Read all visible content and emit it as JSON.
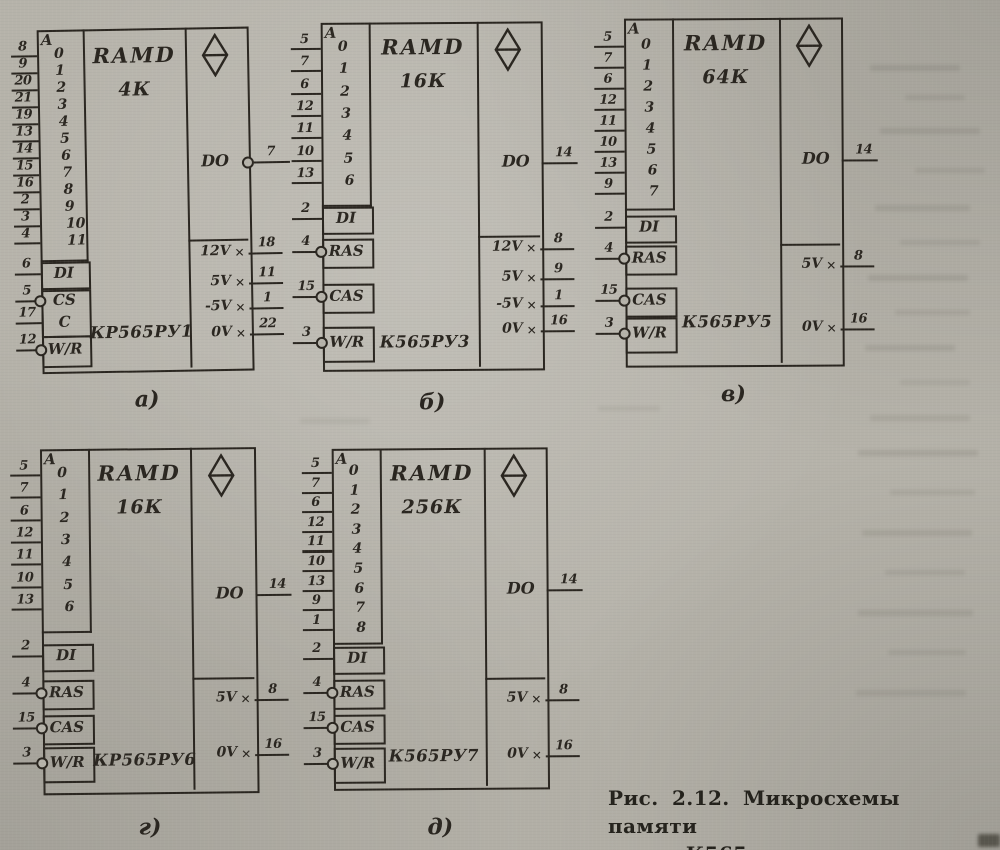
{
  "colors": {
    "paper": "#b6b3aa",
    "ink": "#2a2620"
  },
  "figure_caption": {
    "line1": "Рис. 2.12. Микросхемы памяти",
    "line2": "серии К565"
  },
  "chips": [
    {
      "id": "a",
      "sub_label": "а)",
      "block_label": "RAMD",
      "capacity_label": "4К",
      "part_number": "КР565РУ1",
      "address_header": "A",
      "address_pins": [
        {
          "bit": "0",
          "pin": "8"
        },
        {
          "bit": "1",
          "pin": "9"
        },
        {
          "bit": "2",
          "pin": "20"
        },
        {
          "bit": "3",
          "pin": "21"
        },
        {
          "bit": "4",
          "pin": "19"
        },
        {
          "bit": "5",
          "pin": "13"
        },
        {
          "bit": "6",
          "pin": "14"
        },
        {
          "bit": "7",
          "pin": "15"
        },
        {
          "bit": "8",
          "pin": "16"
        },
        {
          "bit": "9",
          "pin": "2"
        },
        {
          "bit": "10",
          "pin": "3"
        },
        {
          "bit": "11",
          "pin": "4"
        }
      ],
      "control_cells": [
        {
          "items": [
            {
              "label": "DI",
              "pin": "6",
              "bubble": false
            }
          ]
        },
        {
          "items": [
            {
              "label": "CS",
              "pin": "5",
              "bubble": true
            },
            {
              "label": "C",
              "pin": "17",
              "bubble": false
            }
          ]
        },
        {
          "items": [
            {
              "label": "W/R",
              "pin": "12",
              "bubble": true
            }
          ]
        }
      ],
      "output": {
        "label": "DO",
        "pin": "7",
        "bubble": true
      },
      "power_pins": [
        {
          "label": "12V",
          "pin": "18"
        },
        {
          "label": "5V",
          "pin": "11"
        },
        {
          "label": "-5V",
          "pin": "1"
        },
        {
          "label": "0V",
          "pin": "22"
        }
      ],
      "modifier_icon": "diamond"
    },
    {
      "id": "b",
      "sub_label": "б)",
      "block_label": "RAMD",
      "capacity_label": "16К",
      "part_number": "К565РУ3",
      "address_header": "A",
      "address_pins": [
        {
          "bit": "0",
          "pin": "5"
        },
        {
          "bit": "1",
          "pin": "7"
        },
        {
          "bit": "2",
          "pin": "6"
        },
        {
          "bit": "3",
          "pin": "12"
        },
        {
          "bit": "4",
          "pin": "11"
        },
        {
          "bit": "5",
          "pin": "10"
        },
        {
          "bit": "6",
          "pin": "13"
        }
      ],
      "control_cells": [
        {
          "items": [
            {
              "label": "DI",
              "pin": "2",
              "bubble": false
            }
          ]
        },
        {
          "items": [
            {
              "label": "RAS",
              "pin": "4",
              "bubble": true
            }
          ]
        },
        {
          "items": [
            {
              "label": "CAS",
              "pin": "15",
              "bubble": true
            }
          ]
        },
        {
          "items": [
            {
              "label": "W/R",
              "pin": "3",
              "bubble": true
            }
          ]
        }
      ],
      "output": {
        "label": "DO",
        "pin": "14",
        "bubble": false
      },
      "power_pins": [
        {
          "label": "12V",
          "pin": "8"
        },
        {
          "label": "5V",
          "pin": "9"
        },
        {
          "label": "-5V",
          "pin": "1"
        },
        {
          "label": "0V",
          "pin": "16"
        }
      ],
      "modifier_icon": "diamond"
    },
    {
      "id": "v",
      "sub_label": "в)",
      "block_label": "RAMD",
      "capacity_label": "64К",
      "part_number": "К565РУ5",
      "address_header": "A",
      "address_pins": [
        {
          "bit": "0",
          "pin": "5"
        },
        {
          "bit": "1",
          "pin": "7"
        },
        {
          "bit": "2",
          "pin": "6"
        },
        {
          "bit": "3",
          "pin": "12"
        },
        {
          "bit": "4",
          "pin": "11"
        },
        {
          "bit": "5",
          "pin": "10"
        },
        {
          "bit": "6",
          "pin": "13"
        },
        {
          "bit": "7",
          "pin": "9"
        }
      ],
      "control_cells": [
        {
          "items": [
            {
              "label": "DI",
              "pin": "2",
              "bubble": false
            }
          ]
        },
        {
          "items": [
            {
              "label": "RAS",
              "pin": "4",
              "bubble": true
            }
          ]
        },
        {
          "items": [
            {
              "label": "CAS",
              "pin": "15",
              "bubble": true
            }
          ]
        },
        {
          "items": [
            {
              "label": "W/R",
              "pin": "3",
              "bubble": true
            }
          ]
        }
      ],
      "output": {
        "label": "DO",
        "pin": "14",
        "bubble": false
      },
      "power_pins": [
        {
          "label": "5V",
          "pin": "8"
        },
        {
          "label": "0V",
          "pin": "16"
        }
      ],
      "modifier_icon": "diamond"
    },
    {
      "id": "g",
      "sub_label": "г)",
      "block_label": "RAMD",
      "capacity_label": "16К",
      "part_number": "КР565РУ6",
      "address_header": "A",
      "address_pins": [
        {
          "bit": "0",
          "pin": "5"
        },
        {
          "bit": "1",
          "pin": "7"
        },
        {
          "bit": "2",
          "pin": "6"
        },
        {
          "bit": "3",
          "pin": "12"
        },
        {
          "bit": "4",
          "pin": "11"
        },
        {
          "bit": "5",
          "pin": "10"
        },
        {
          "bit": "6",
          "pin": "13"
        }
      ],
      "control_cells": [
        {
          "items": [
            {
              "label": "DI",
              "pin": "2",
              "bubble": false
            }
          ]
        },
        {
          "items": [
            {
              "label": "RAS",
              "pin": "4",
              "bubble": true
            }
          ]
        },
        {
          "items": [
            {
              "label": "CAS",
              "pin": "15",
              "bubble": true
            }
          ]
        },
        {
          "items": [
            {
              "label": "W/R",
              "pin": "3",
              "bubble": true
            }
          ]
        }
      ],
      "output": {
        "label": "DO",
        "pin": "14",
        "bubble": false
      },
      "power_pins": [
        {
          "label": "5V",
          "pin": "8"
        },
        {
          "label": "0V",
          "pin": "16"
        }
      ],
      "modifier_icon": "diamond"
    },
    {
      "id": "d",
      "sub_label": "д)",
      "block_label": "RAMD",
      "capacity_label": "256К",
      "part_number": "К565РУ7",
      "address_header": "A",
      "address_pins": [
        {
          "bit": "0",
          "pin": "5"
        },
        {
          "bit": "1",
          "pin": "7"
        },
        {
          "bit": "2",
          "pin": "6"
        },
        {
          "bit": "3",
          "pin": "12"
        },
        {
          "bit": "4",
          "pin": "11"
        },
        {
          "bit": "5",
          "pin": "10"
        },
        {
          "bit": "6",
          "pin": "13"
        },
        {
          "bit": "7",
          "pin": "9"
        },
        {
          "bit": "8",
          "pin": "1"
        }
      ],
      "control_cells": [
        {
          "items": [
            {
              "label": "DI",
              "pin": "2",
              "bubble": false
            }
          ]
        },
        {
          "items": [
            {
              "label": "RAS",
              "pin": "4",
              "bubble": true
            }
          ]
        },
        {
          "items": [
            {
              "label": "CAS",
              "pin": "15",
              "bubble": true
            }
          ]
        },
        {
          "items": [
            {
              "label": "W/R",
              "pin": "3",
              "bubble": true
            }
          ]
        }
      ],
      "output": {
        "label": "DO",
        "pin": "14",
        "bubble": false
      },
      "power_pins": [
        {
          "label": "5V",
          "pin": "8"
        },
        {
          "label": "0V",
          "pin": "16"
        }
      ],
      "modifier_icon": "diamond"
    }
  ]
}
